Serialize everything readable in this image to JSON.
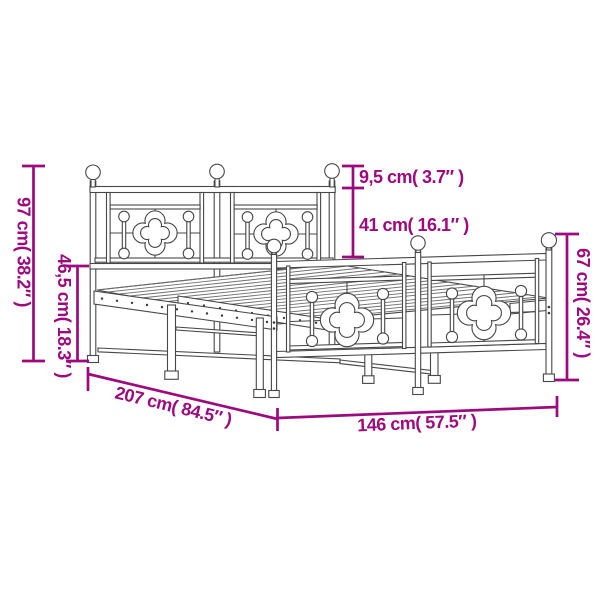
{
  "page": {
    "background": "#ffffff"
  },
  "colors": {
    "dimension_accent": "#9C0A7D",
    "drawing_line": "#474747"
  },
  "diagram": {
    "subject": "metal bed frame with headboard and footboard",
    "dimensions": {
      "headboard_height": {
        "label": "97 cm( 38.2″ )",
        "cm": 97,
        "inch": 38.2
      },
      "platform_height": {
        "label": "46,5 cm( 18.3″ )",
        "cm": 46.5,
        "inch": 18.3
      },
      "finial_section": {
        "label": "9,5 cm( 3.7″ )",
        "cm": 9.5,
        "inch": 3.7
      },
      "headboard_panel": {
        "label": "41 cm( 16.1″ )",
        "cm": 41,
        "inch": 16.1
      },
      "footboard_height": {
        "label": "67 cm( 26.4″ )",
        "cm": 67,
        "inch": 26.4
      },
      "bed_length": {
        "label": "207 cm( 84.5″ )",
        "cm": 207,
        "inch": 84.5
      },
      "bed_width": {
        "label": "146 cm( 57.5″ )",
        "cm": 146,
        "inch": 57.5
      }
    }
  }
}
